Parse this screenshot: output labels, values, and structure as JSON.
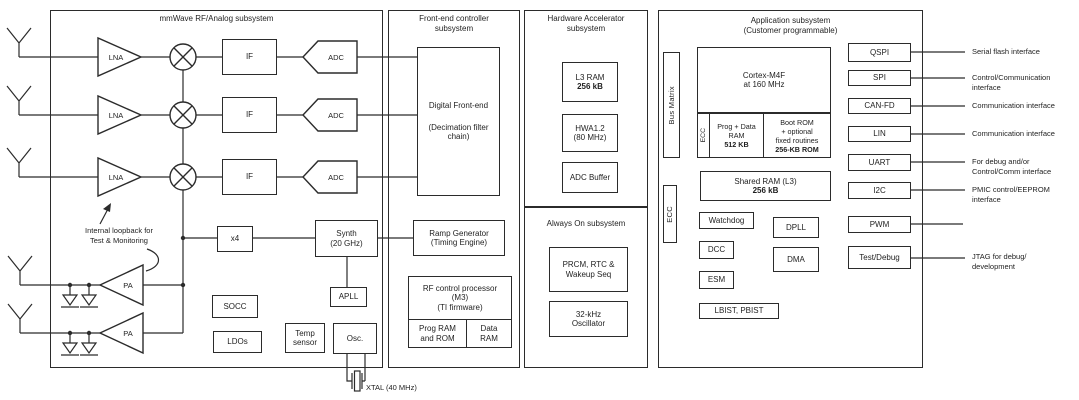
{
  "mmwave": {
    "title": "mmWave RF/Analog subsystem",
    "lna": "LNA",
    "if": "IF",
    "adc": "ADC",
    "pa": "PA",
    "x4": "x4",
    "synth": [
      "Synth",
      "(20 GHz)"
    ],
    "apll": "APLL",
    "socc": "SOCC",
    "ldos": "LDOs",
    "temp": [
      "Temp",
      "sensor"
    ],
    "osc": "Osc.",
    "loopback": [
      "Internal loopback for",
      "Test & Monitoring"
    ],
    "xtal": "XTAL (40 MHz)"
  },
  "frontend": {
    "title": [
      "Front-end controller",
      "subsystem"
    ],
    "dfe": [
      "Digital Front-end",
      "(Decimation filter",
      "chain)"
    ],
    "ramp": [
      "Ramp Generator",
      "(Timing Engine)"
    ],
    "rfproc": [
      "RF control processor",
      "(M3)",
      "(TI firmware)"
    ],
    "prog_ram": [
      "Prog RAM",
      "and ROM"
    ],
    "data_ram": [
      "Data",
      "RAM"
    ]
  },
  "hwa": {
    "title": [
      "Hardware Accelerator",
      "subsystem"
    ],
    "l3ram": [
      "L3 RAM",
      "256 kB"
    ],
    "hwa12": [
      "HWA1.2",
      "(80 MHz)"
    ],
    "adc_buffer": "ADC Buffer"
  },
  "alwayson": {
    "title": "Always On subsystem",
    "prcm": [
      "PRCM, RTC &",
      "Wakeup Seq"
    ],
    "osc32": [
      "32-kHz",
      "Oscillator"
    ]
  },
  "app": {
    "title": [
      "Application subsystem",
      "(Customer programmable)"
    ],
    "bus_matrix": "Bus Matrix",
    "ecc_left": "ECC",
    "ecc_mem": "ECC",
    "cortex": [
      "Cortex-M4F",
      "at 160 MHz"
    ],
    "prog_data": [
      "Prog + Data",
      "RAM",
      "512 KB"
    ],
    "boot_rom": [
      "Boot ROM",
      "+ optional",
      "fixed routines",
      "256-KB ROM"
    ],
    "shared_ram": [
      "Shared RAM (L3)",
      "256 kB"
    ],
    "watchdog": "Watchdog",
    "dpll": "DPLL",
    "dcc": "DCC",
    "dma": "DMA",
    "esm": "ESM",
    "lbist": "LBIST, PBIST"
  },
  "interfaces": [
    {
      "label": "QSPI",
      "desc": "Serial flash interface"
    },
    {
      "label": "SPI",
      "desc": "Control/Communication\ninterface"
    },
    {
      "label": "CAN-FD",
      "desc": "Communication interface"
    },
    {
      "label": "LIN",
      "desc": "Communication interface"
    },
    {
      "label": "UART",
      "desc": "For debug and/or\nControl/Comm interface"
    },
    {
      "label": "I2C",
      "desc": "PMIC control/EEPROM\ninterface"
    },
    {
      "label": "PWM",
      "desc": ""
    },
    {
      "label": "Test/Debug",
      "desc": "JTAG for debug/\ndevelopment"
    }
  ],
  "colors": {
    "line": "#2b2b2b",
    "text": "#1f1f1f",
    "bg": "#ffffff"
  }
}
